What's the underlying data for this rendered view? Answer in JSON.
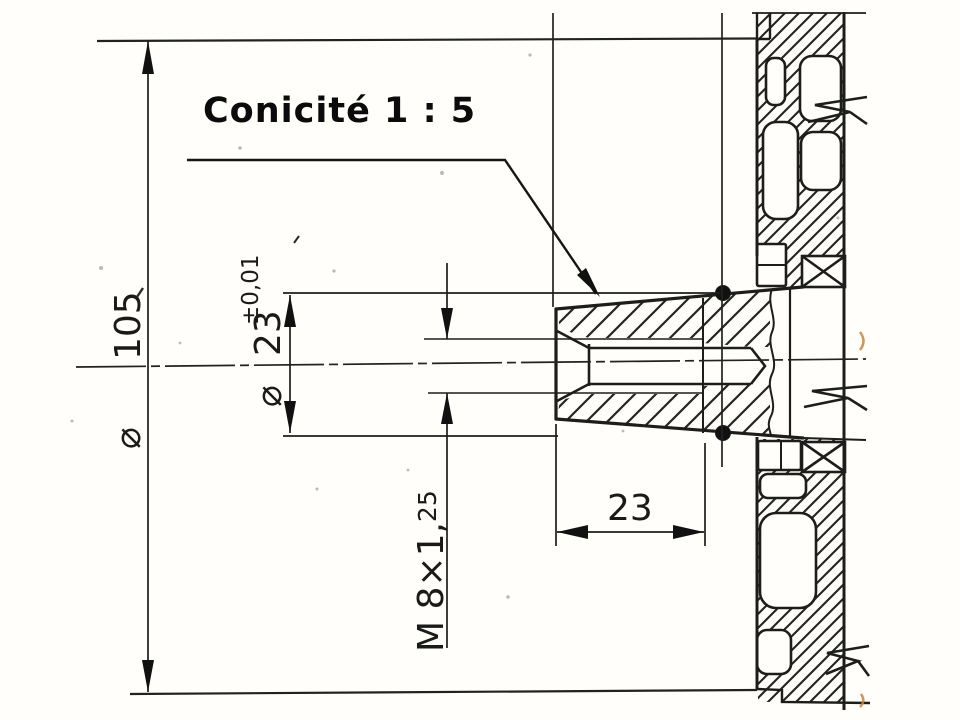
{
  "drawing": {
    "title": "Conicité 1 : 5",
    "dimensions": {
      "outer_diameter": {
        "symbol": "⌀",
        "value": "105"
      },
      "taper_diameter": {
        "symbol": "⌀",
        "value": "23",
        "tolerance": "±0,01"
      },
      "thread": {
        "designation": "M 8×1,",
        "pitch_suffix": "25"
      },
      "taper_length": {
        "value": "23"
      }
    },
    "colors": {
      "ink": "#1d1d1b",
      "paper": "#fffefb",
      "artifact": "#c8823c"
    }
  }
}
